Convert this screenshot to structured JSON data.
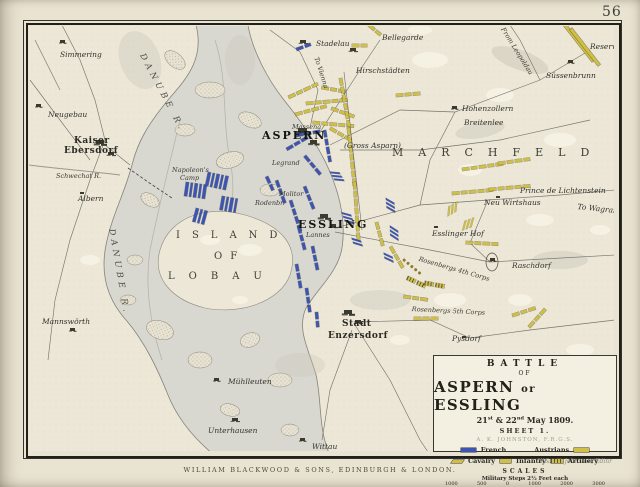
{
  "page": {
    "number": "56",
    "publisher_line": "WILLIAM BLACKWOOD & SONS, EDINBURGH & LONDON.",
    "engraver_credit": "W.&A.K. Johnston, Edinr"
  },
  "cartouche": {
    "title_top": "BATTLE",
    "title_of": "OF",
    "title_main_a": "ASPERN",
    "title_main_or": "or",
    "title_main_b": "ESSLING",
    "date": {
      "d1": "21",
      "s1": "st",
      "d2": " & 22",
      "s2": "nd",
      "rest": " May 1809."
    },
    "sheet": "SHEET 1.",
    "author": "A. K. JOHNSTON, F.R.G.S.",
    "legend": {
      "french_label": "French",
      "austrians_label": "Austrians",
      "cavalry_label": "Cavalry",
      "infantry_label": "Infantry",
      "artillery_label": "Artillery",
      "french_color": "#3d55b2",
      "austrian_color": "#cfbf45"
    },
    "scales": {
      "heading": "SCALES",
      "steps_caption": "Military Steps 2½ Feet each",
      "steps_ticks": [
        "1000",
        "500",
        "0",
        "1000",
        "2000",
        "3000"
      ],
      "miles_caption": "English Miles",
      "miles_ticks": [
        "¼",
        "½",
        "¾",
        "1",
        "1½"
      ]
    }
  },
  "map": {
    "labels": [
      {
        "text": "Simmering",
        "x": 60,
        "y": 50,
        "cls": "ital"
      },
      {
        "text": "Neugebau",
        "x": 48,
        "y": 110,
        "cls": "ital"
      },
      {
        "text": "Kaiser",
        "x": 74,
        "y": 136,
        "cls": "town-lg"
      },
      {
        "text": "Ebersdorf",
        "x": 64,
        "y": 146,
        "cls": "town-lg"
      },
      {
        "text": "Schwechat R.",
        "x": 56,
        "y": 172,
        "cls": "tiny-ital"
      },
      {
        "text": "Albern",
        "x": 78,
        "y": 194,
        "cls": "ital"
      },
      {
        "text": "Mannswörth",
        "x": 42,
        "y": 317,
        "cls": "ital"
      },
      {
        "text": "Süller",
        "x": 322,
        "y": 20,
        "cls": "tiny"
      },
      {
        "text": "Stadelau",
        "x": 316,
        "y": 39,
        "cls": "ital"
      },
      {
        "text": "To Vienna",
        "x": 320,
        "y": 56,
        "cls": "tiny-ital",
        "rot": 72
      },
      {
        "text": "Bellegarde",
        "x": 382,
        "y": 33,
        "cls": "ital"
      },
      {
        "text": "Hirschstädten",
        "x": 356,
        "y": 66,
        "cls": "ital"
      },
      {
        "text": "Hohenzollern",
        "x": 462,
        "y": 104,
        "cls": "ital"
      },
      {
        "text": "Breitenlee",
        "x": 464,
        "y": 118,
        "cls": "ital"
      },
      {
        "text": "From Leopoldau",
        "x": 506,
        "y": 26,
        "cls": "tiny-ital",
        "rot": 58
      },
      {
        "text": "Reserve",
        "x": 590,
        "y": 42,
        "cls": "ital"
      },
      {
        "text": "Süssenbrunn",
        "x": 546,
        "y": 71,
        "cls": "ital"
      },
      {
        "text": "ASPERN",
        "x": 262,
        "y": 129,
        "cls": "city"
      },
      {
        "text": "(Gross Asparn)",
        "x": 344,
        "y": 141,
        "cls": "ital"
      },
      {
        "text": "Massena",
        "x": 292,
        "y": 123,
        "cls": "tiny-ital"
      },
      {
        "text": "Legrand",
        "x": 272,
        "y": 159,
        "cls": "tiny-ital"
      },
      {
        "text": "Molitor",
        "x": 279,
        "y": 190,
        "cls": "tiny-ital"
      },
      {
        "text": "Rodenbr.",
        "x": 255,
        "y": 199,
        "cls": "tiny-ital"
      },
      {
        "text": "ESSLING",
        "x": 298,
        "y": 218,
        "cls": "city"
      },
      {
        "text": "Lannes",
        "x": 306,
        "y": 231,
        "cls": "tiny-ital"
      },
      {
        "text": "Napoleon's",
        "x": 172,
        "y": 166,
        "cls": "tiny-ital"
      },
      {
        "text": "Camp",
        "x": 180,
        "y": 174,
        "cls": "tiny-ital"
      },
      {
        "text": "MARCHFELD",
        "x": 392,
        "y": 146,
        "cls": "region",
        "ls": 15
      },
      {
        "text": "ISLAND",
        "x": 176,
        "y": 230,
        "cls": "region2",
        "ls": 12
      },
      {
        "text": "OF",
        "x": 214,
        "y": 251,
        "cls": "region2",
        "ls": 8
      },
      {
        "text": "LOBAU",
        "x": 168,
        "y": 271,
        "cls": "region2",
        "ls": 14
      },
      {
        "text": "DANUBE R.",
        "x": 146,
        "y": 52,
        "cls": "river",
        "rot": 62,
        "ls": 4
      },
      {
        "text": "DANUBE R.",
        "x": 116,
        "y": 228,
        "cls": "river",
        "rot": 80,
        "ls": 4
      },
      {
        "text": "Neu Wirtshaus",
        "x": 484,
        "y": 198,
        "cls": "ital"
      },
      {
        "text": "Prince de Lichtenstein",
        "x": 520,
        "y": 186,
        "cls": "ital"
      },
      {
        "text": "To Wagram",
        "x": 578,
        "y": 202,
        "cls": "ital",
        "rot": 6
      },
      {
        "text": "Esslinger Hof",
        "x": 432,
        "y": 229,
        "cls": "ital"
      },
      {
        "text": "Raschdorf",
        "x": 512,
        "y": 261,
        "cls": "ital"
      },
      {
        "text": "Rosenbergs 4th Corps",
        "x": 420,
        "y": 255,
        "cls": "tiny-ital",
        "rot": 16
      },
      {
        "text": "Rosenbergs 5th Corps",
        "x": 412,
        "y": 305,
        "cls": "tiny-ital",
        "rot": 3
      },
      {
        "text": "Pysdorf",
        "x": 452,
        "y": 334,
        "cls": "ital"
      },
      {
        "text": "Stadt",
        "x": 342,
        "y": 319,
        "cls": "town-lg"
      },
      {
        "text": "Enzersdorf",
        "x": 328,
        "y": 331,
        "cls": "town-lg"
      },
      {
        "text": "Mühlleuten",
        "x": 228,
        "y": 377,
        "cls": "ital"
      },
      {
        "text": "Unterhausen",
        "x": 208,
        "y": 426,
        "cls": "ital"
      },
      {
        "text": "Wittau",
        "x": 312,
        "y": 442,
        "cls": "ital"
      }
    ],
    "towns": [
      {
        "x": 298,
        "y": 128,
        "s": 9
      },
      {
        "x": 310,
        "y": 140,
        "s": 7
      },
      {
        "x": 320,
        "y": 214,
        "s": 8
      },
      {
        "x": 330,
        "y": 224,
        "s": 6
      },
      {
        "x": 344,
        "y": 310,
        "s": 8
      },
      {
        "x": 355,
        "y": 320,
        "s": 6
      },
      {
        "x": 96,
        "y": 140,
        "s": 8
      },
      {
        "x": 108,
        "y": 152,
        "s": 6
      },
      {
        "x": 300,
        "y": 40,
        "s": 6
      },
      {
        "x": 350,
        "y": 48,
        "s": 6
      },
      {
        "x": 568,
        "y": 60,
        "s": 5
      },
      {
        "x": 452,
        "y": 106,
        "s": 5
      },
      {
        "x": 490,
        "y": 258,
        "s": 5
      },
      {
        "x": 214,
        "y": 378,
        "s": 5
      },
      {
        "x": 232,
        "y": 418,
        "s": 6
      },
      {
        "x": 300,
        "y": 438,
        "s": 5
      },
      {
        "x": 70,
        "y": 328,
        "s": 5
      },
      {
        "x": 36,
        "y": 104,
        "s": 5
      },
      {
        "x": 60,
        "y": 40,
        "s": 5
      },
      {
        "x": 80,
        "y": 192,
        "s": 4
      },
      {
        "x": 496,
        "y": 196,
        "s": 4
      },
      {
        "x": 462,
        "y": 336,
        "s": 4
      },
      {
        "x": 434,
        "y": 226,
        "s": 4
      }
    ],
    "units": [
      {
        "s": "au",
        "k": "b",
        "x": 288,
        "y": 96,
        "r": -25,
        "c": 4
      },
      {
        "s": "au",
        "k": "b",
        "x": 306,
        "y": 102,
        "r": -5,
        "c": 5
      },
      {
        "s": "au",
        "k": "b",
        "x": 332,
        "y": 107,
        "r": 20,
        "c": 3
      },
      {
        "s": "au",
        "k": "b",
        "x": 295,
        "y": 113,
        "r": -15,
        "c": 4
      },
      {
        "s": "au",
        "k": "b",
        "x": 313,
        "y": 121,
        "r": 5,
        "c": 5
      },
      {
        "s": "au",
        "k": "b",
        "x": 331,
        "y": 127,
        "r": 30,
        "c": 3
      },
      {
        "s": "au",
        "k": "b",
        "x": 322,
        "y": 86,
        "r": 10,
        "c": 3
      },
      {
        "s": "au",
        "k": "b",
        "x": 352,
        "y": 44,
        "r": 0,
        "c": 2
      },
      {
        "s": "au",
        "k": "b",
        "x": 370,
        "y": 24,
        "r": 40,
        "c": 2
      },
      {
        "s": "au",
        "k": "b",
        "x": 396,
        "y": 94,
        "r": -5,
        "c": 3
      },
      {
        "s": "au",
        "k": "b",
        "x": 342,
        "y": 78,
        "r": 80,
        "c": 6
      },
      {
        "s": "au",
        "k": "b",
        "x": 350,
        "y": 128,
        "r": 84,
        "c": 7
      },
      {
        "s": "au",
        "k": "b",
        "x": 356,
        "y": 182,
        "r": 86,
        "c": 7
      },
      {
        "s": "au",
        "k": "strip",
        "x": 566,
        "y": 24,
        "r": 52,
        "len": 46
      },
      {
        "s": "au",
        "k": "strip",
        "x": 572,
        "y": 28,
        "r": 52,
        "len": 46
      },
      {
        "s": "au",
        "k": "b",
        "x": 462,
        "y": 168,
        "r": -8,
        "c": 5
      },
      {
        "s": "au",
        "k": "b",
        "x": 498,
        "y": 162,
        "r": -8,
        "c": 4
      },
      {
        "s": "au",
        "k": "b",
        "x": 452,
        "y": 192,
        "r": -5,
        "c": 5
      },
      {
        "s": "au",
        "k": "b",
        "x": 489,
        "y": 188,
        "r": -5,
        "c": 5
      },
      {
        "s": "au",
        "k": "b",
        "x": 466,
        "y": 241,
        "r": 3,
        "c": 4
      },
      {
        "s": "au",
        "k": "b",
        "x": 404,
        "y": 295,
        "r": 8,
        "c": 3
      },
      {
        "s": "au",
        "k": "b",
        "x": 414,
        "y": 317,
        "r": 0,
        "c": 3
      },
      {
        "s": "au",
        "k": "b",
        "x": 512,
        "y": 314,
        "r": -18,
        "c": 3
      },
      {
        "s": "au",
        "k": "b",
        "x": 528,
        "y": 326,
        "r": -48,
        "c": 3
      },
      {
        "s": "au",
        "k": "b",
        "x": 378,
        "y": 222,
        "r": 75,
        "c": 3
      },
      {
        "s": "au",
        "k": "b",
        "x": 392,
        "y": 246,
        "r": 60,
        "c": 3
      },
      {
        "s": "au",
        "k": "art",
        "x": 408,
        "y": 276,
        "r": 25,
        "c": 2
      },
      {
        "s": "au",
        "k": "art",
        "x": 425,
        "y": 281,
        "r": 10,
        "c": 2
      },
      {
        "s": "au",
        "k": "cav",
        "x": 446,
        "y": 208,
        "r": -30,
        "c": 3
      },
      {
        "s": "au",
        "k": "cav",
        "x": 462,
        "y": 222,
        "r": -20,
        "c": 3
      },
      {
        "s": "au",
        "k": "dot",
        "x": 404,
        "y": 258,
        "r": 40,
        "c": 5
      },
      {
        "s": "fr",
        "k": "tall",
        "x": 186,
        "y": 182,
        "r": 8,
        "c": 5
      },
      {
        "s": "fr",
        "k": "tall",
        "x": 208,
        "y": 172,
        "r": 12,
        "c": 5
      },
      {
        "s": "fr",
        "k": "tall",
        "x": 222,
        "y": 196,
        "r": 10,
        "c": 4
      },
      {
        "s": "fr",
        "k": "tall",
        "x": 196,
        "y": 208,
        "r": 15,
        "c": 3
      },
      {
        "s": "fr",
        "k": "b",
        "x": 296,
        "y": 134,
        "r": -10,
        "c": 3
      },
      {
        "s": "fr",
        "k": "b",
        "x": 286,
        "y": 148,
        "r": -30,
        "c": 3
      },
      {
        "s": "fr",
        "k": "b",
        "x": 306,
        "y": 155,
        "r": 50,
        "c": 3
      },
      {
        "s": "fr",
        "k": "b",
        "x": 326,
        "y": 130,
        "r": 80,
        "c": 4
      },
      {
        "s": "fr",
        "k": "b",
        "x": 278,
        "y": 180,
        "r": 70,
        "c": 3
      },
      {
        "s": "fr",
        "k": "b",
        "x": 292,
        "y": 200,
        "r": 72,
        "c": 4
      },
      {
        "s": "fr",
        "k": "b",
        "x": 306,
        "y": 186,
        "r": 68,
        "c": 3
      },
      {
        "s": "fr",
        "k": "b",
        "x": 300,
        "y": 226,
        "r": 75,
        "c": 3
      },
      {
        "s": "fr",
        "k": "b",
        "x": 314,
        "y": 246,
        "r": 78,
        "c": 3
      },
      {
        "s": "fr",
        "k": "b",
        "x": 298,
        "y": 264,
        "r": 80,
        "c": 3
      },
      {
        "s": "fr",
        "k": "b",
        "x": 308,
        "y": 288,
        "r": 82,
        "c": 3
      },
      {
        "s": "fr",
        "k": "b",
        "x": 318,
        "y": 312,
        "r": 85,
        "c": 2
      },
      {
        "s": "fr",
        "k": "cav",
        "x": 338,
        "y": 170,
        "r": 60,
        "c": 3
      },
      {
        "s": "fr",
        "k": "cav",
        "x": 350,
        "y": 212,
        "r": 70,
        "c": 3
      },
      {
        "s": "fr",
        "k": "cav",
        "x": 360,
        "y": 238,
        "r": 72,
        "c": 2
      },
      {
        "s": "fr",
        "k": "cav",
        "x": 394,
        "y": 200,
        "r": 85,
        "c": 3
      },
      {
        "s": "fr",
        "k": "cav",
        "x": 398,
        "y": 228,
        "r": 88,
        "c": 3
      },
      {
        "s": "fr",
        "k": "cav",
        "x": 392,
        "y": 254,
        "r": 80,
        "c": 2
      },
      {
        "s": "fr",
        "k": "b",
        "x": 296,
        "y": 48,
        "r": -20,
        "c": 2
      },
      {
        "s": "fr",
        "k": "b",
        "x": 268,
        "y": 176,
        "r": 65,
        "c": 2
      }
    ]
  }
}
